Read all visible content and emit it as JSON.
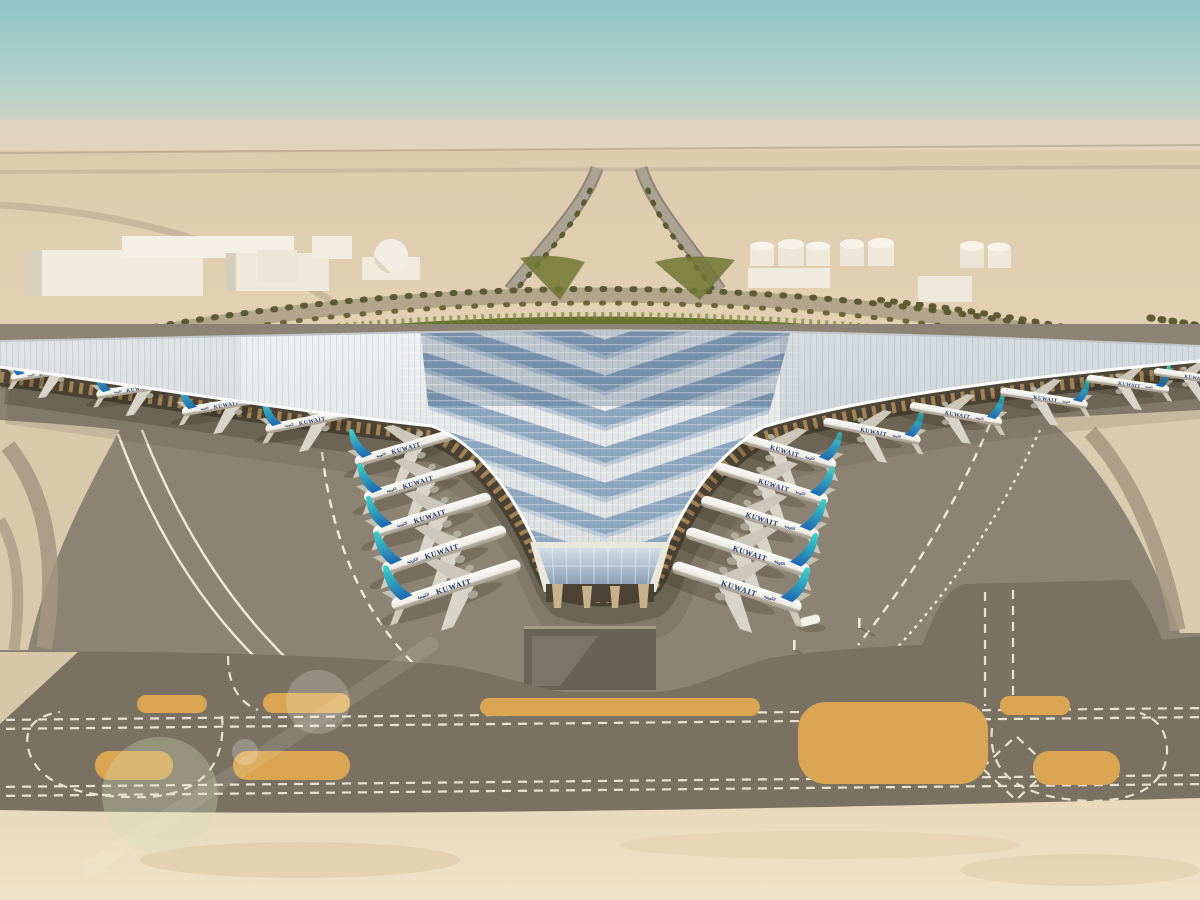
{
  "scene": {
    "subject": "airport-terminal-aerial-rendering"
  },
  "aircraft": {
    "airline_title": "KUWAIT",
    "airline_title_arabic": "الكويتية",
    "left_concourse_count": 4,
    "left_pier_count": 5,
    "right_pier_count": 5,
    "right_concourse_count": 5,
    "ground_vehicle_count": 1
  },
  "palette": {
    "sky_top": "#8fc5c8",
    "sky_horizon": "#e6d6bd",
    "desert_sand": "#e0cfae",
    "apron_gray": "#8d8375",
    "taxiway_gray": "#7a7163",
    "island_orange": "#d9a553",
    "marking_white": "#efe9da",
    "landscape_green": "#67702c",
    "roof_silver": "#eef0f1",
    "roof_skylight_blue": "#8ea7c1",
    "tail_teal": "#3ecfc8",
    "tail_blue": "#1f66b2",
    "fuselage_white": "#fbfbf7"
  }
}
